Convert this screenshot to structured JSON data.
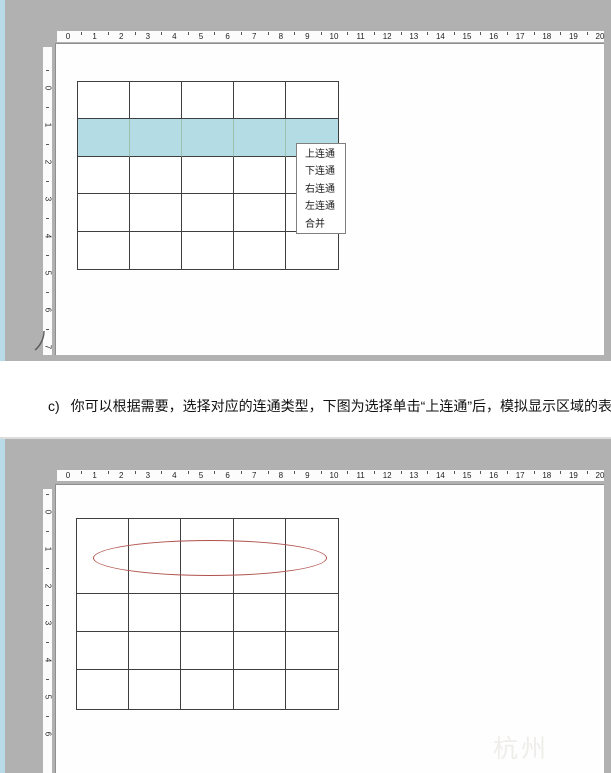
{
  "caption": {
    "prefix": "c)",
    "text": "你可以根据需要，选择对应的连通类型，下图为选择单击“上连通”后，模拟显示区域的表格情"
  },
  "colors": {
    "highlight_blue": "#b3dce5",
    "ellipse_red": "#b0514b",
    "panel_gray": "#b1b1b1",
    "left_strip_blue": "#b9dbe7"
  },
  "panel_top": {
    "h_ruler_numbers": [
      0,
      1,
      2,
      3,
      4,
      5,
      6,
      7,
      8,
      9,
      10,
      11,
      12,
      13,
      14,
      15,
      16,
      17,
      18,
      19,
      20
    ],
    "v_ruler_numbers": [
      0,
      1,
      2,
      3,
      4,
      5,
      6,
      7
    ],
    "table": {
      "columns": 5,
      "rows": 5,
      "highlighted_row_index": 1
    },
    "context_menu": {
      "items": [
        "上连通",
        "下连通",
        "右连通",
        "左连通",
        "合并"
      ]
    }
  },
  "panel_bottom": {
    "h_ruler_numbers": [
      0,
      1,
      2,
      3,
      4,
      5,
      6,
      7,
      8,
      9,
      10,
      11,
      12,
      13,
      14,
      15,
      16,
      17,
      18,
      19,
      20
    ],
    "v_ruler_numbers": [
      0,
      1,
      2,
      3,
      4,
      5,
      6
    ],
    "table": {
      "columns": 5,
      "rows": 4,
      "merged_first_row": true
    },
    "watermark": "杭州"
  }
}
